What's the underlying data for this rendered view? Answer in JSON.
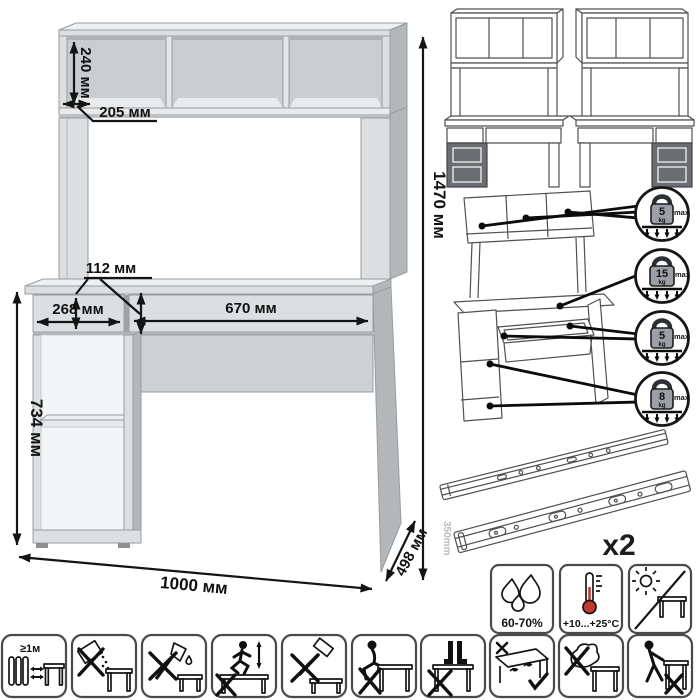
{
  "main_drawing": {
    "dimensions": {
      "hutch_inner_height": "240 мм",
      "hutch_depth": "205 мм",
      "drawer_front_height": "112 мм",
      "left_section_width": "268 мм",
      "drawer_width": "670 мм",
      "underdesk_height": "734 мм",
      "overall_height": "1470 мм",
      "overall_width": "1000 мм",
      "overall_depth": "498 мм"
    }
  },
  "load_limits": {
    "items": [
      {
        "value": "5",
        "unit": "kg",
        "qualifier": "max"
      },
      {
        "value": "15",
        "unit": "kg",
        "qualifier": "max"
      },
      {
        "value": "5",
        "unit": "kg",
        "qualifier": "max"
      },
      {
        "value": "8",
        "unit": "kg",
        "qualifier": "max"
      }
    ]
  },
  "hardware_slides": {
    "length_label": "350mm",
    "quantity_label": "x2"
  },
  "environment": {
    "humidity_range": "60-70%",
    "temperature_range": "+10...+25°C"
  },
  "safety": {
    "heat_distance_label": "≥1м"
  },
  "colors": {
    "furniture_light": "#dcdfe1",
    "furniture_side": "#b3b7ba",
    "accent_dark_panel": "#6a6e72",
    "dimension_ink": "#141414",
    "thermometer_red": "#c23b2d",
    "slide_length_gray": "#b9b9b9"
  }
}
